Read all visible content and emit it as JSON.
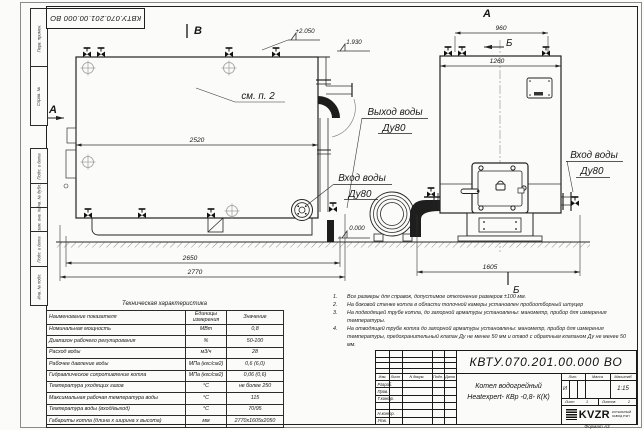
{
  "sheet": {
    "stamp_top": "КВТУ.070.201.00.000  ВО",
    "format_note": "Формат   А3"
  },
  "frame_labels": {
    "perv": "Перв. примен.",
    "sprav": "Справ. №",
    "podp1": "Подп. и дата",
    "inv_dubl": "Инв. № дубл.",
    "vzam": "Взам. инв. №",
    "podp2": "Подп. и дата",
    "inv_podl": "Инв. № подл."
  },
  "drawing": {
    "view_letters": {
      "a": "А",
      "b": "В",
      "section": "Б"
    },
    "callouts": {
      "see_item": "см. п. 2",
      "water_outlet_line1": "Выход воды",
      "water_outlet_line2": "Ду80",
      "water_inlet_line1": "Вход воды",
      "water_inlet_line2": "Ду80"
    },
    "dimensions": {
      "front_width": "2520",
      "front_base": "2650",
      "front_overall": "2770",
      "top_nozzles": "960",
      "side_width": "1260",
      "side_overall": "1605"
    },
    "elevations": {
      "top": "+2.050",
      "outlet": "1.930",
      "zero": "0.000"
    }
  },
  "tech_table": {
    "title": "Техническая характеристика",
    "col_name": "Наименование показателя",
    "col_units_line1": "Единицы",
    "col_units_line2": "измерения",
    "col_value": "Значение",
    "rows": [
      {
        "name": "Номинальная мощность",
        "units": "МВт",
        "value": "0,8"
      },
      {
        "name": "Диапазон рабочего регулирования",
        "units": "%",
        "value": "50-100"
      },
      {
        "name": "Расход воды",
        "units": "м3/ч",
        "value": "28"
      },
      {
        "name": "Рабочее давление воды",
        "units": "МПа (кгс/см2)",
        "value": "0,6 (6,0)"
      },
      {
        "name": "Гидравлическое сопротивление котла",
        "units": "МПа (кгс/см2)",
        "value": "0,06 (0,6)"
      },
      {
        "name": "Температура уходящих газов",
        "units": "°С",
        "value": "не более 250"
      },
      {
        "name": "Максимальная рабочая температура воды",
        "units": "°С",
        "value": "115"
      },
      {
        "name": "Температура воды (вход/выход)",
        "units": "°С",
        "value": "70/95"
      },
      {
        "name": "Габариты котла (длина х ширина х высота)",
        "units": "мм",
        "value": "2770х1605х2050"
      }
    ]
  },
  "notes": {
    "items": [
      {
        "num": "1.",
        "text": "Все размеры для справок, допустимое отклонение размеров ±100 мм."
      },
      {
        "num": "2.",
        "text": "На боковой стенке котла в области топочной камеры установлен пробоотборный штуцер"
      },
      {
        "num": "3.",
        "text": "На  подводящей трубе котла, до запорной арматуры установлены: манометр, прибор для измерения температуры."
      },
      {
        "num": "4.",
        "text": "На отводящей трубе котла до запорной арматуры установлены: манометр, прибор для измерения температуры, предохранительный клапан Ду не менее 50 мм и отвод с обратным клапаном Ду не менее 50 мм."
      }
    ]
  },
  "title_block": {
    "doc_number": "КВТУ.070.201.00.000  ВО",
    "name_line1": "Котел водогрейный",
    "name_line2": "Heatexpert- КВр -0,8- К(К)",
    "lit_header": "Лит.",
    "mass_header": "Масса",
    "scale_header": "Масштаб",
    "lit_value": "И",
    "scale_value": "1:15",
    "sheet_label": "Лист",
    "sheet_number": "1",
    "sheets_label": "Листов",
    "sheets_total": "2",
    "cols": {
      "izm": "Изм.",
      "list": "Лист",
      "docnum": "N докум.",
      "podp": "Подп.",
      "data": "Дата"
    },
    "roles": {
      "r1": "Разраб.",
      "r2": "Пров.",
      "r3": "Т.контр.",
      "r4": "Н.контр.",
      "r5": "Утв."
    },
    "logo_text": "KVZR",
    "logo_caption1": "КОТЕЛЬНЫЙ",
    "logo_caption2": "ЗАВОД РЭП"
  }
}
